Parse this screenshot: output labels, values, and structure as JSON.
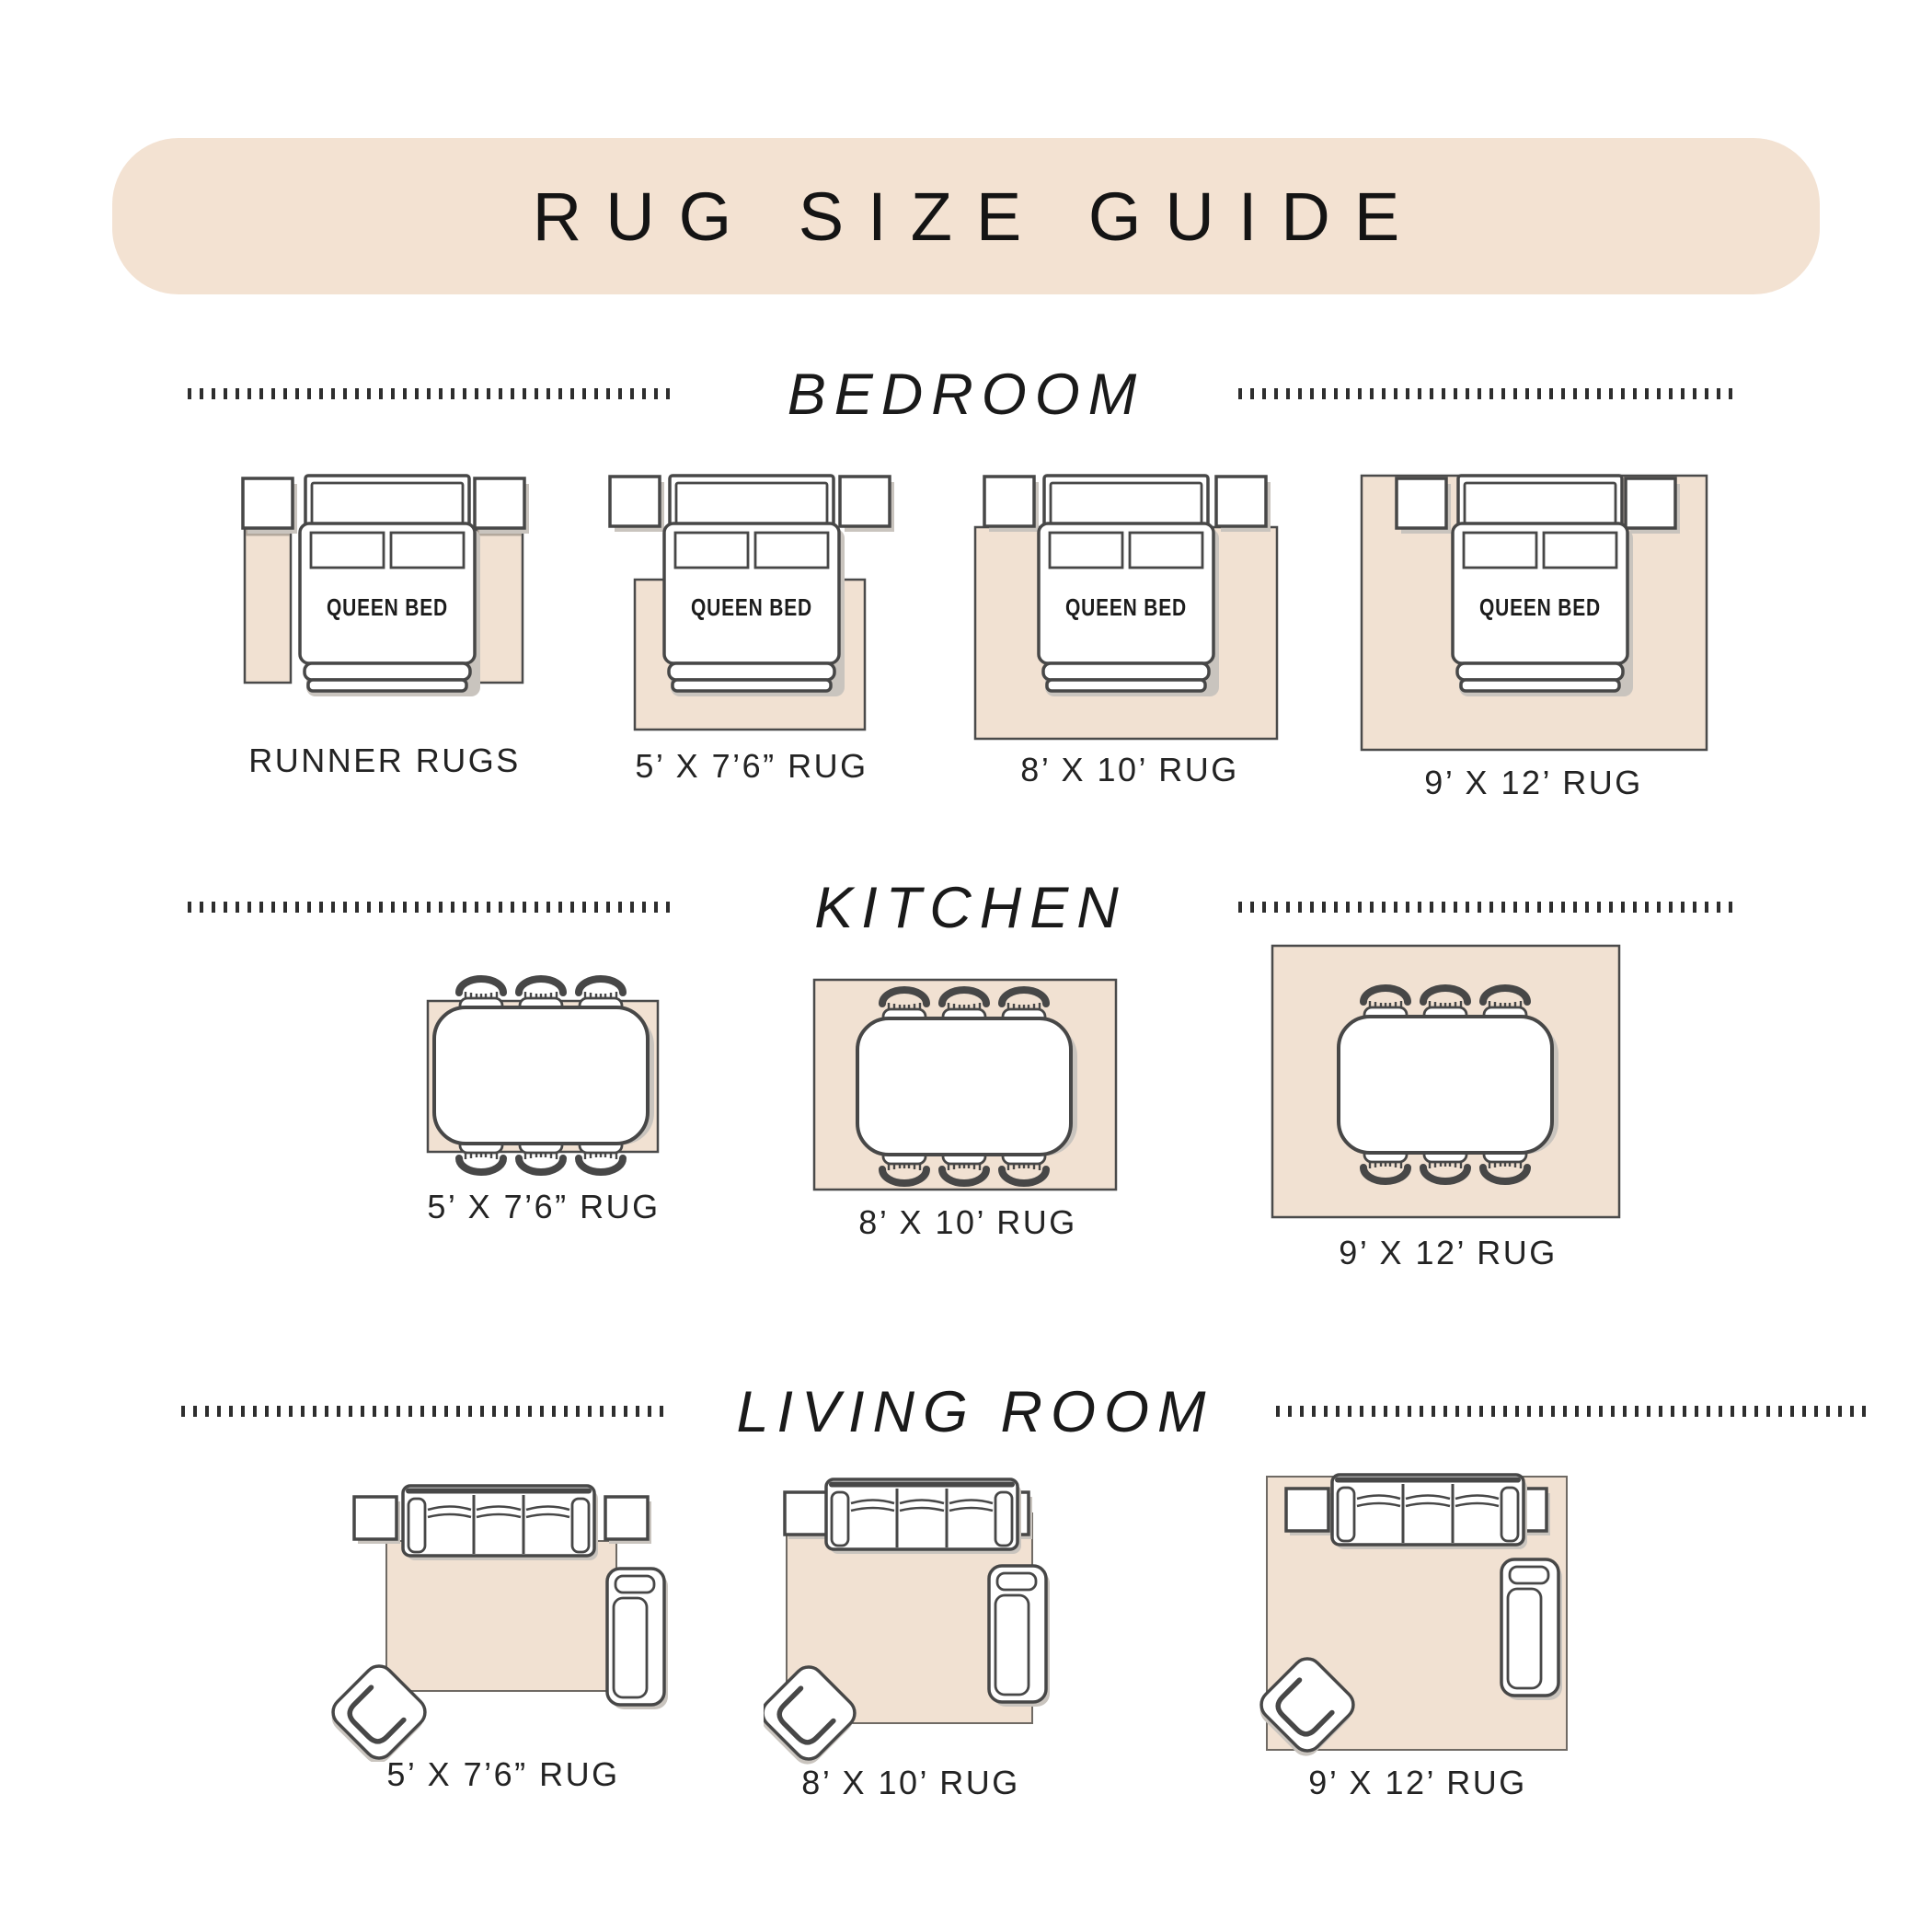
{
  "title": "RUG SIZE GUIDE",
  "bed_label": "QUEEN BED",
  "sections": [
    {
      "id": "bedroom",
      "heading": "BEDROOM",
      "items": [
        {
          "label": "RUNNER RUGS"
        },
        {
          "label": "5’ X 7’6” RUG"
        },
        {
          "label": "8’ X 10’ RUG"
        },
        {
          "label": "9’ X 12’ RUG"
        }
      ]
    },
    {
      "id": "kitchen",
      "heading": "KITCHEN",
      "items": [
        {
          "label": "5’ X 7’6” RUG"
        },
        {
          "label": "8’ X 10’ RUG"
        },
        {
          "label": "9’ X 12’ RUG"
        }
      ]
    },
    {
      "id": "living-room",
      "heading": "LIVING ROOM",
      "items": [
        {
          "label": "5’ X 7’6” RUG"
        },
        {
          "label": "8’ X 10’ RUG"
        },
        {
          "label": "9’ X 12’ RUG"
        }
      ]
    }
  ],
  "colors": {
    "banner": "#f3e2d2",
    "rug": "#f1e1d2",
    "rug-border": "#4a4a4a",
    "outline": "#474747",
    "shadow": "#c9c4be",
    "runner-shade": "#b3a89c",
    "text": "#232323",
    "dots": "#2e2e2e"
  }
}
